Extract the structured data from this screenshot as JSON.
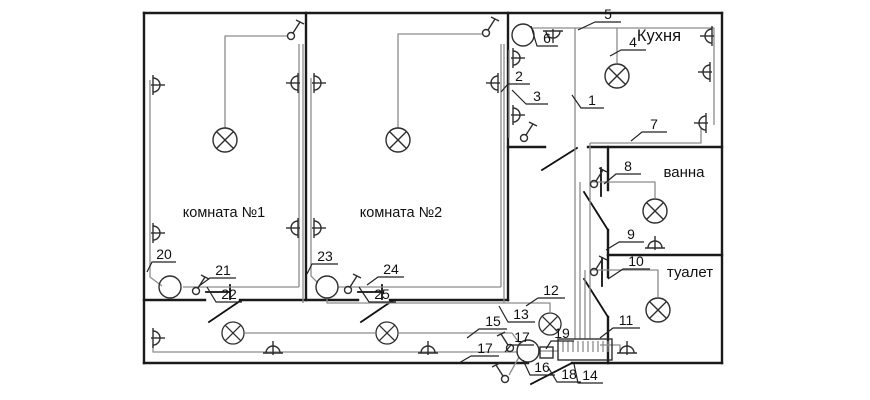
{
  "diagram": {
    "type": "apartment electrical wiring floor plan",
    "rooms": {
      "room1": "комната №1",
      "room2": "комната №2",
      "kitchen": "Кухня",
      "bath": "ванна",
      "toilet": "туалет"
    },
    "callouts": [
      {
        "n": "1"
      },
      {
        "n": "2"
      },
      {
        "n": "3"
      },
      {
        "n": "4"
      },
      {
        "n": "5"
      },
      {
        "n": "6"
      },
      {
        "n": "7"
      },
      {
        "n": "8"
      },
      {
        "n": "9"
      },
      {
        "n": "10"
      },
      {
        "n": "11"
      },
      {
        "n": "12"
      },
      {
        "n": "13"
      },
      {
        "n": "14"
      },
      {
        "n": "15"
      },
      {
        "n": "16"
      },
      {
        "n": "17"
      },
      {
        "n": "17"
      },
      {
        "n": "18"
      },
      {
        "n": "19"
      },
      {
        "n": "20"
      },
      {
        "n": "21"
      },
      {
        "n": "22"
      },
      {
        "n": "23"
      },
      {
        "n": "24"
      },
      {
        "n": "25"
      }
    ],
    "colors": {
      "wall": "#1a1a1a",
      "wire": "#8c8c8c",
      "background": "#ffffff"
    }
  }
}
